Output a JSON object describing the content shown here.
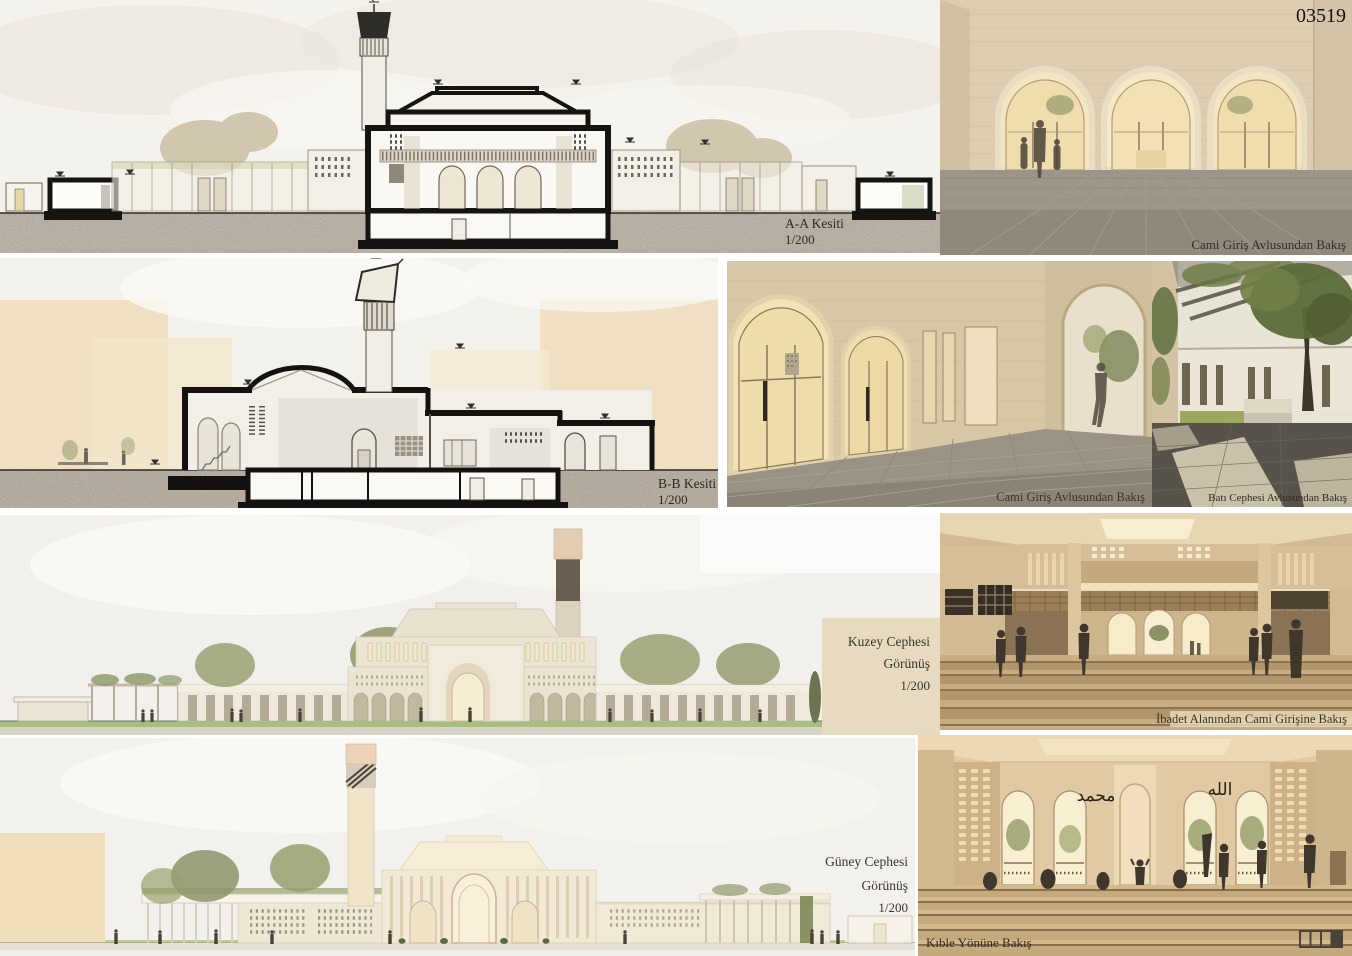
{
  "board": {
    "id_number": "03519",
    "scale": "1/200"
  },
  "panels": {
    "section_aa": {
      "title": "A-A Kesiti",
      "scale": "1/200"
    },
    "section_bb": {
      "title": "B-B Kesiti",
      "scale": "1/200"
    },
    "elevation_north": {
      "title": "Kuzey Cephesi",
      "subtitle": "Görünüş",
      "scale": "1/200"
    },
    "elevation_south": {
      "title": "Güney Cephesi",
      "subtitle": "Görünüş",
      "scale": "1/200"
    },
    "render_entry_courtyard_top": {
      "caption": "Cami Giriş Avlusundan Bakış"
    },
    "render_entry_courtyard_mid": {
      "caption": "Cami Giriş Avlusundan Bakış"
    },
    "render_west_courtyard": {
      "caption": "Batı Cephesi Avlusundan Bakış"
    },
    "render_prayer_hall": {
      "caption": "İbadet Alanından Cami Girişine Bakış"
    },
    "render_qibla": {
      "caption": "Kıble Yönüne Bakış",
      "calligraphy": [
        "محمد",
        "الله"
      ],
      "sheet_indicator": {
        "cells": 4,
        "active_index": 4
      }
    }
  },
  "palette": {
    "paper": "#ffffff",
    "section_sky": "#efece6",
    "ground_texture": "#b2a89b",
    "ink": "#1a1816",
    "context_beige": "#eedcbb",
    "stone_wall": "#d9c9ab",
    "warm_glow": "#f4e6c2",
    "pavement_gray": "#948c7e",
    "dark_pavement": "#55514a",
    "foliage_green": "#6d7a47",
    "carpet_tan": "#c3a87e",
    "silhouette": "#433a2e",
    "label_ink": "#332d24"
  }
}
